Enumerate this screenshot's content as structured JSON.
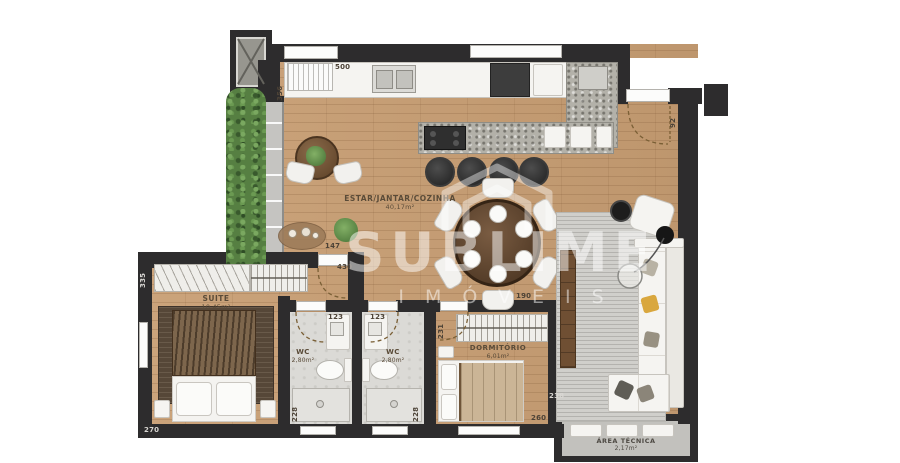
{
  "watermark": {
    "brand": "SUBLIME",
    "subtitle": "IMÓVEIS"
  },
  "rooms": {
    "living": {
      "name": "ESTAR/JANTAR/COZINHA",
      "area": "40,17m²"
    },
    "suite": {
      "name": "SUITE",
      "area": "10,45m²"
    },
    "wc1": {
      "name": "WC",
      "area": "2,80m²"
    },
    "wc2": {
      "name": "WC",
      "area": "2,80m²"
    },
    "dormitorio": {
      "name": "DORMITÓRIO",
      "area": "6,01m²"
    },
    "area_tecnica": {
      "name": "ÁREA TÉCNICA",
      "area": "2,17m²"
    }
  },
  "dimensions": {
    "kitchen_counter": "500",
    "balcony_wall": "356",
    "suite_left_wall": "335",
    "suite_width": "270",
    "hall_width": "147",
    "hall_length": "430",
    "wc1_width": "123",
    "wc2_width": "123",
    "wc1_depth": "228",
    "wc2_depth": "228",
    "dorm_wall": "231",
    "dorm_closet": "190",
    "dorm_width": "260",
    "living_right": "238",
    "entry_door": "92"
  },
  "colors": {
    "wall": "#2d2c2d",
    "wood_floor": "#c89e73",
    "tile_floor": "#dbdad6",
    "hedge_green": "#567f42",
    "accent_pillow": "#d9a73e"
  }
}
